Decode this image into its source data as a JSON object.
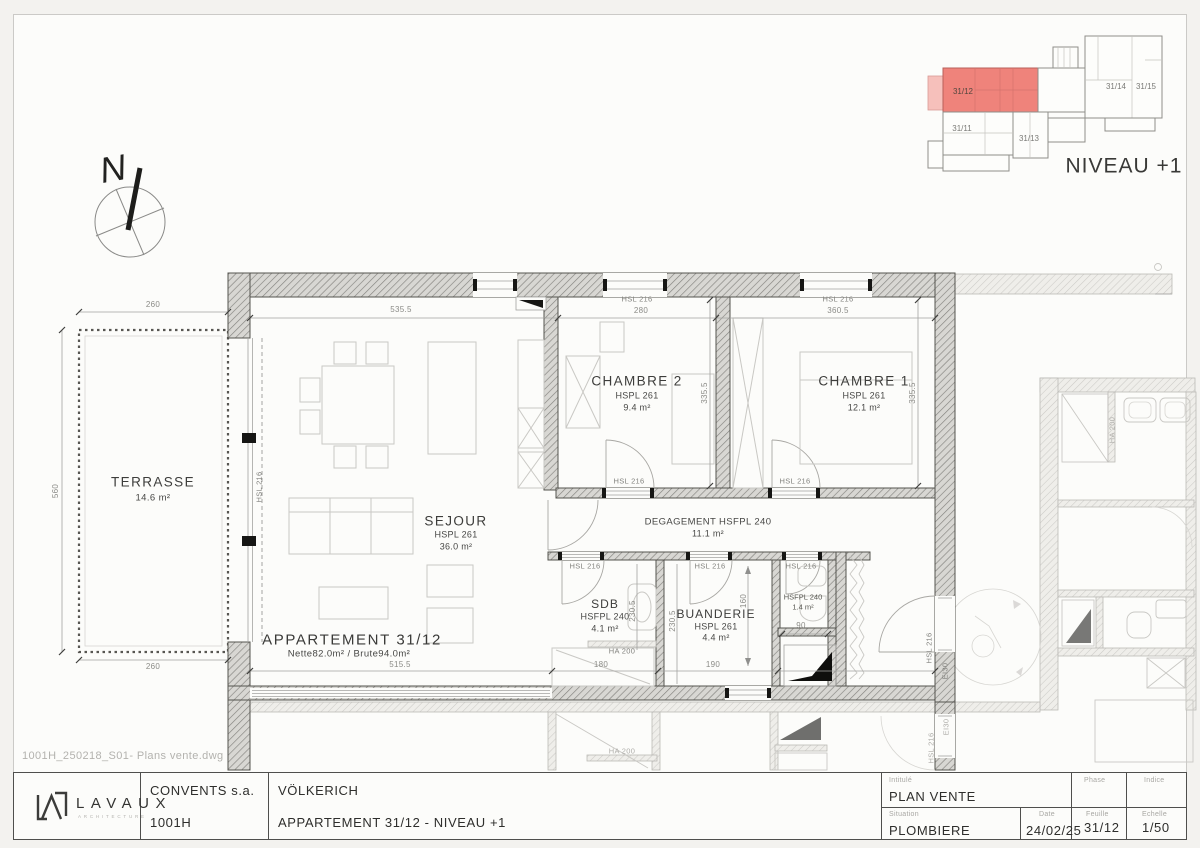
{
  "sheet": {
    "file_name": "1001H_250218_S01- Plans vente.dwg",
    "compass_letter": "N"
  },
  "key_plan": {
    "level_label": "NIVEAU +1",
    "highlight_color": "#ef837b",
    "units": {
      "u3112": "31/12",
      "u3111": "31/11",
      "u3113": "31/13",
      "u3114": "31/14",
      "u3115": "31/15"
    }
  },
  "rooms": {
    "terrasse": {
      "name": "TERRASSE",
      "area": "14.6 m²"
    },
    "sejour": {
      "name": "SEJOUR",
      "height": "HSPL 261",
      "area": "36.0 m²"
    },
    "chambre2": {
      "name": "CHAMBRE 2",
      "height": "HSPL 261",
      "area": "9.4 m²"
    },
    "chambre1": {
      "name": "CHAMBRE 1",
      "height": "HSPL 261",
      "area": "12.1 m²"
    },
    "degagement": {
      "name": "DEGAGEMENT HSFPL 240",
      "area": "11.1 m²"
    },
    "sdb": {
      "name": "SDB",
      "height": "HSFPL 240",
      "area": "4.1 m²"
    },
    "buanderie": {
      "name": "BUANDERIE",
      "height": "HSPL 261",
      "area": "4.4 m²"
    },
    "wc": {
      "height": "HSFPL 240",
      "area": "1.4 m²"
    },
    "apartment": {
      "name": "APPARTEMENT 31/12",
      "areas": "Nette82.0m² / Brute94.0m²"
    }
  },
  "dims": {
    "terrace_top": "260",
    "terrace_left": "560",
    "terrace_bottom": "260",
    "sejour_top": "535.5",
    "ch2_window": "HSL 216",
    "ch2_width": "280",
    "ch1_window": "HSL 216",
    "ch1_width": "360.5",
    "ch2_depth": "335.5",
    "ch1_depth": "335.5",
    "ch2_door": "HSL 216",
    "ch1_door": "HSL 216",
    "sdb_door": "HSL 216",
    "buanderie_door": "HSL 216",
    "wc_door": "HSL 216",
    "sdb_width": "230.5",
    "buanderie_width": "230.5",
    "buanderie_length": "160",
    "wc_clearance": "90",
    "sdb_halfwall": "HA 200",
    "sdb_bottom": "180",
    "buanderie_bottom": "190",
    "apartment_bottom": "515.5",
    "terrace_window": "HSL 216",
    "entry_door": "HSL 216",
    "entry_fire_rating": "EI30",
    "lower_halfwall": "HA 200",
    "lower_door": "HSL 216",
    "lower_fire_rating": "EI30",
    "neighbor_halfwall": "HA 200"
  },
  "title_block": {
    "logo_text": "LAVAUX",
    "logo_subtext": "ARCHITECTURE",
    "client": "CONVENTS s.a.",
    "project_number": "1001H",
    "project_name": "VÖLKERICH",
    "drawing_title": "APPARTEMENT 31/12 - NIVEAU +1",
    "labels": {
      "intitule": "Intitulé",
      "phase": "Phase",
      "indice": "Indice",
      "situation": "Situation",
      "date": "Date",
      "feuille": "Feuille",
      "echelle": "Echelle"
    },
    "intitule": "PLAN VENTE",
    "phase": "",
    "indice": "",
    "situation": "PLOMBIERE",
    "date": "24/02/25",
    "feuille": "31/12",
    "echelle": "1/50"
  }
}
